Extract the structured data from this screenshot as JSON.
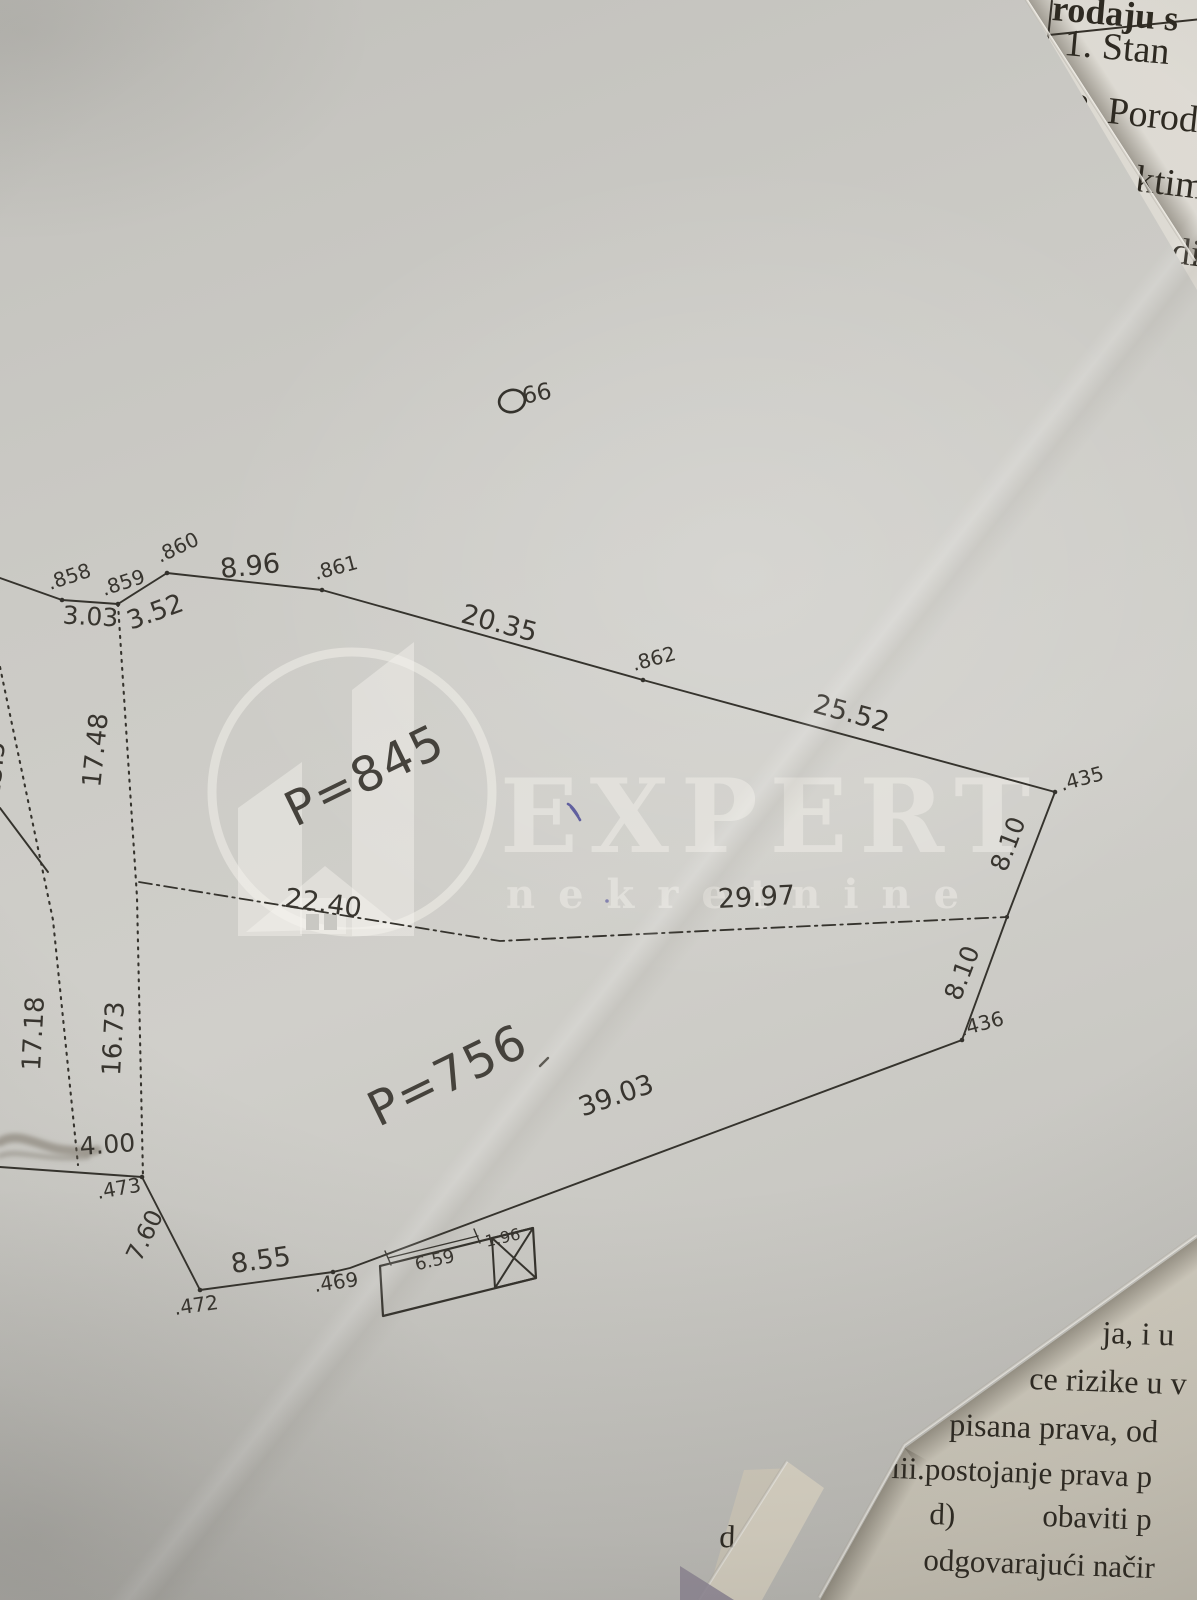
{
  "watermark": {
    "brand": "EXPERT",
    "tagline": "nekretnine"
  },
  "plan": {
    "areas": {
      "upper": "P=845",
      "lower": "P=756"
    },
    "manhole": "66",
    "points": {
      "p858": ".858",
      "p859": ".859",
      "p860": ".860",
      "p861": ".861",
      "p862": ".862",
      "p435": ".435",
      "p436": ".436",
      "p473": ".473",
      "p472": ".472",
      "p469": ".469"
    },
    "dims": {
      "d858_859": "3.03",
      "d859_860": "3.52",
      "d860_861": "8.96",
      "d861_862": "20.35",
      "d862_435": "25.52",
      "d435_j": "8.10",
      "dj_436": "8.10",
      "d_mid_upper": "22.40",
      "d_mid_lower": "29.97",
      "v_17_48": "17.48",
      "v_16_73": "16.73",
      "v_17_18": "17.18",
      "v_left_partial": "15.5",
      "d4_00": "4.00",
      "d7_60": "7.60",
      "d8_55": "8.55",
      "d39_03": "39.03",
      "bld_w": "6.59",
      "bld_annex": "1.96"
    }
  },
  "underlying_pages": {
    "top_right": {
      "heading": "rodaju s",
      "item1": "1. Stan",
      "item2": "2. Porod",
      "frag1": "ktim",
      "frag2": "di"
    },
    "bottom_right": {
      "l1": "ja, i u",
      "l2": "ce rizike u v",
      "l3": "pisana prava, od",
      "l4": "iii.postojanje prava p",
      "l5a": "d)",
      "l5b": "obaviti p",
      "l6": "odgovarajući načir",
      "stray1": "d",
      "stray2": "o"
    }
  }
}
